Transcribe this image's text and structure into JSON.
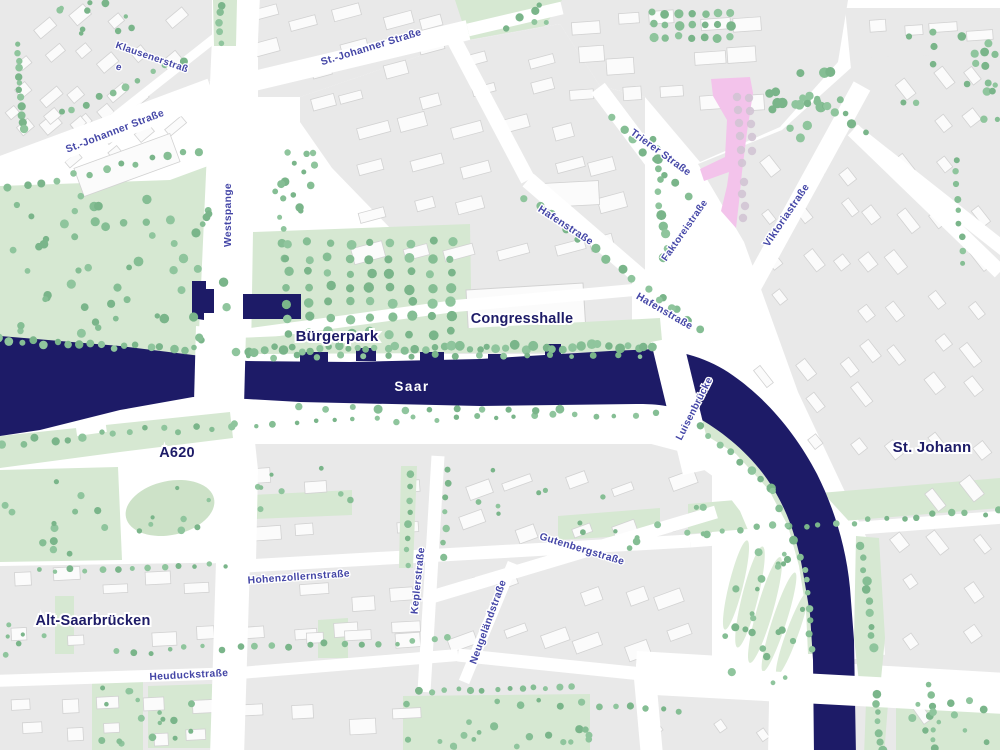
{
  "map": {
    "region": "Saarbrücken",
    "colors": {
      "background": "#ffffff",
      "river": "#1d1b67",
      "block": "#e9e9e9",
      "building": "#fbfbfb",
      "building_outline": "#d2d2d2",
      "park": "#d6e8d2",
      "park_light": "#dcebd7",
      "tree": "#85be94",
      "pink_area": "#f3c3eb",
      "pink_dots": "#d2c4d4",
      "area_label": "#1d1b67",
      "street_label": "#4345a6",
      "water_label": "#ffffff"
    },
    "labels": {
      "water": [
        {
          "id": "saar",
          "text": "Saar",
          "x": 412,
          "y": 391,
          "rot": 0,
          "size": 13.5
        }
      ],
      "areas": [
        {
          "id": "buergerpark",
          "text": "Bürgerpark",
          "x": 337,
          "y": 341,
          "rot": 0,
          "size": 15
        },
        {
          "id": "congresshalle",
          "text": "Congresshalle",
          "x": 522,
          "y": 323,
          "rot": 0,
          "size": 14.5
        },
        {
          "id": "a620",
          "text": "A620",
          "x": 177,
          "y": 457,
          "rot": 0,
          "size": 14.5
        },
        {
          "id": "alt-saarbruecken",
          "text": "Alt-Saarbrücken",
          "x": 93,
          "y": 625,
          "rot": 0,
          "size": 14.5
        },
        {
          "id": "st-johann",
          "text": "St. Johann",
          "x": 932,
          "y": 452,
          "rot": 0,
          "size": 15
        }
      ],
      "streets": [
        {
          "id": "klausenerstrasse",
          "text": "Klausenerstraß",
          "x": 151,
          "y": 60,
          "rot": 19,
          "size": 9.8
        },
        {
          "id": "klausenerstrasse-wrap",
          "text": "e",
          "x": 118,
          "y": 70,
          "rot": 19,
          "size": 9.8
        },
        {
          "id": "st-johanner-strasse-w",
          "text": "St.-Johanner Straße",
          "x": 116,
          "y": 134,
          "rot": -21,
          "size": 10.3
        },
        {
          "id": "st-johanner-strasse-n",
          "text": "St.-Johanner Straße",
          "x": 372,
          "y": 50,
          "rot": -17,
          "size": 10.3
        },
        {
          "id": "westspange",
          "text": "Westspange",
          "x": 231,
          "y": 215,
          "rot": -90,
          "size": 10.3
        },
        {
          "id": "hafenstrasse-n",
          "text": "Hafenstraße",
          "x": 564,
          "y": 228,
          "rot": 33,
          "size": 10.3
        },
        {
          "id": "hafenstrasse-s",
          "text": "Hafenstraße",
          "x": 663,
          "y": 314,
          "rot": 30,
          "size": 10.3
        },
        {
          "id": "trierer-strasse",
          "text": "Trierer Straße",
          "x": 659,
          "y": 155,
          "rot": 36,
          "size": 10.3
        },
        {
          "id": "faktoreistrasse",
          "text": "Faktoreistraße",
          "x": 687,
          "y": 232,
          "rot": -55,
          "size": 9.8
        },
        {
          "id": "viktoriastrasse",
          "text": "Viktoriastraße",
          "x": 789,
          "y": 217,
          "rot": -56,
          "size": 10.3
        },
        {
          "id": "luisenbruecke",
          "text": "Luisenbrücke",
          "x": 697,
          "y": 410,
          "rot": -63,
          "size": 10
        },
        {
          "id": "hohenzollernstrasse",
          "text": "Hohenzollernstraße",
          "x": 299,
          "y": 580,
          "rot": -4,
          "size": 10.3
        },
        {
          "id": "heuduckstrasse",
          "text": "Heuduckstraße",
          "x": 189,
          "y": 678,
          "rot": -3,
          "size": 10.3
        },
        {
          "id": "keplerstrasse",
          "text": "Keplerstraße",
          "x": 421,
          "y": 581,
          "rot": -84,
          "size": 10.3
        },
        {
          "id": "neugelaendstrasse",
          "text": "Neugeländstraße",
          "x": 491,
          "y": 623,
          "rot": -70,
          "size": 10.3
        },
        {
          "id": "gutenbergstrasse",
          "text": "Gutenbergstraße",
          "x": 581,
          "y": 552,
          "rot": 17,
          "size": 10.3
        }
      ]
    }
  }
}
